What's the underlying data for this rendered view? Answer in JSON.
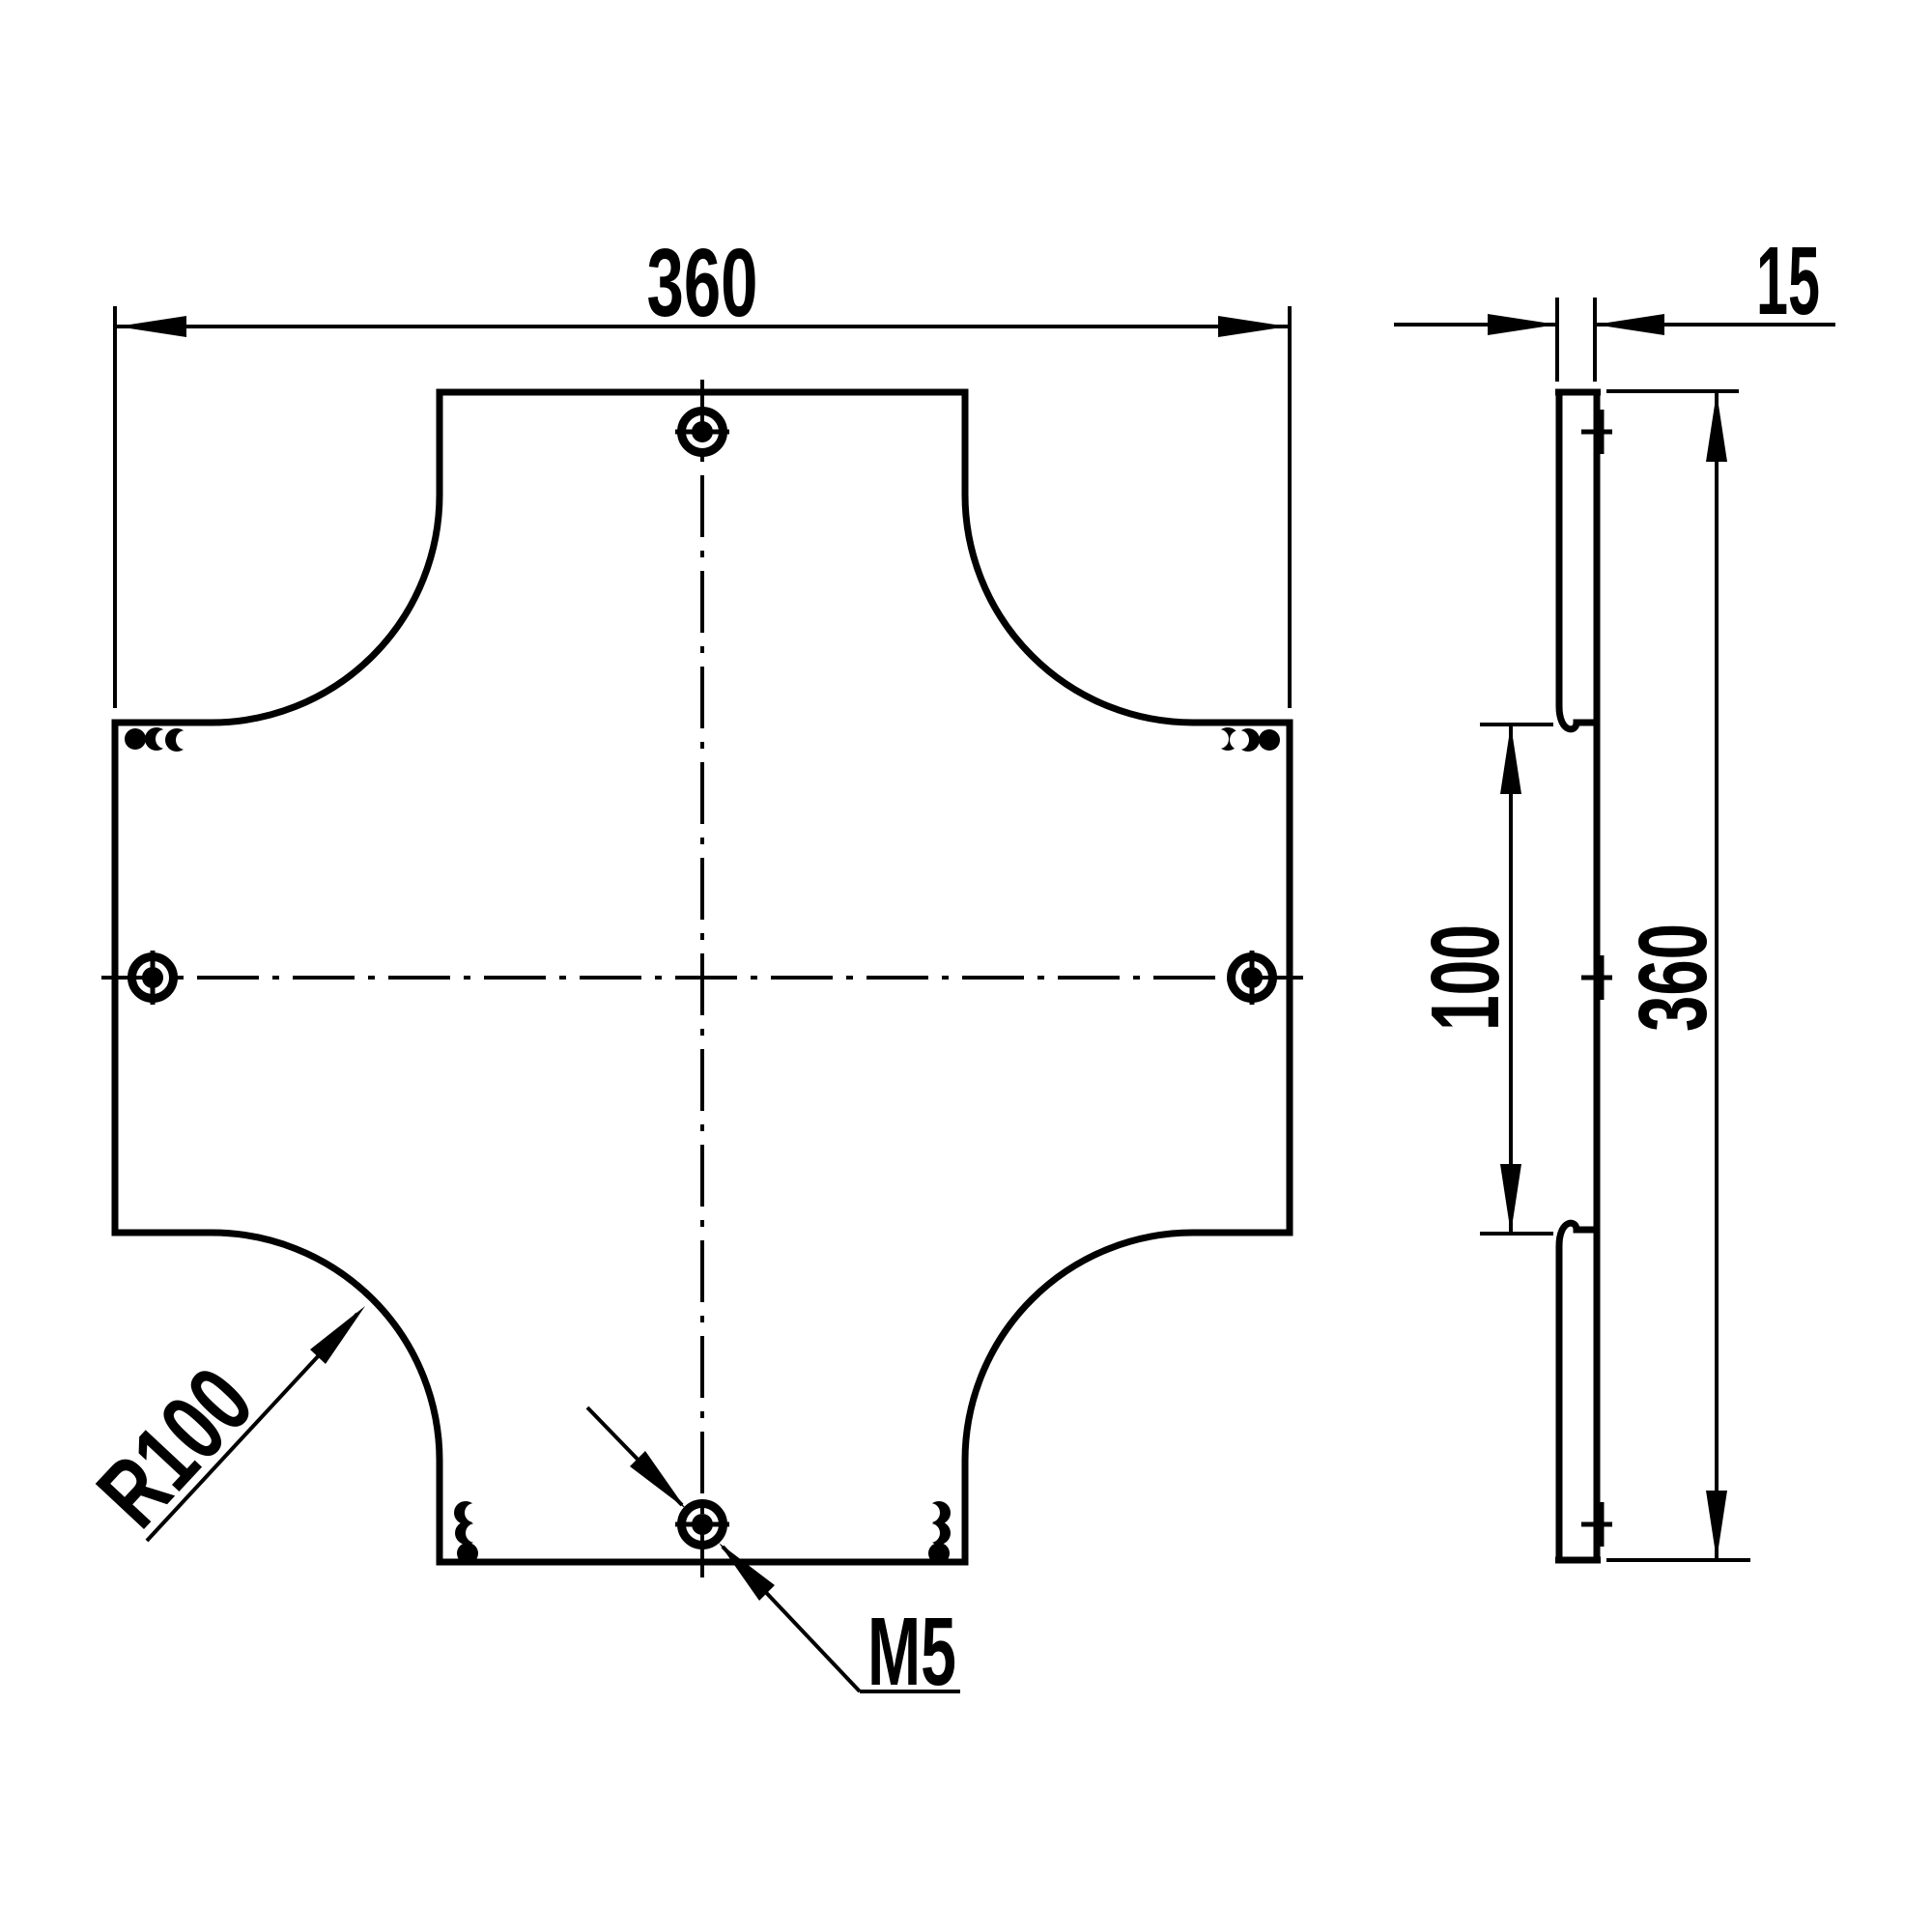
{
  "colors": {
    "background": "#ffffff",
    "line": "#000000"
  },
  "top_view": {
    "width_dim": "360",
    "corner_radius": "R100",
    "thread": "M5"
  },
  "side_view": {
    "thickness_dim": "15",
    "opening_dim": "100",
    "height_dim": "360"
  }
}
